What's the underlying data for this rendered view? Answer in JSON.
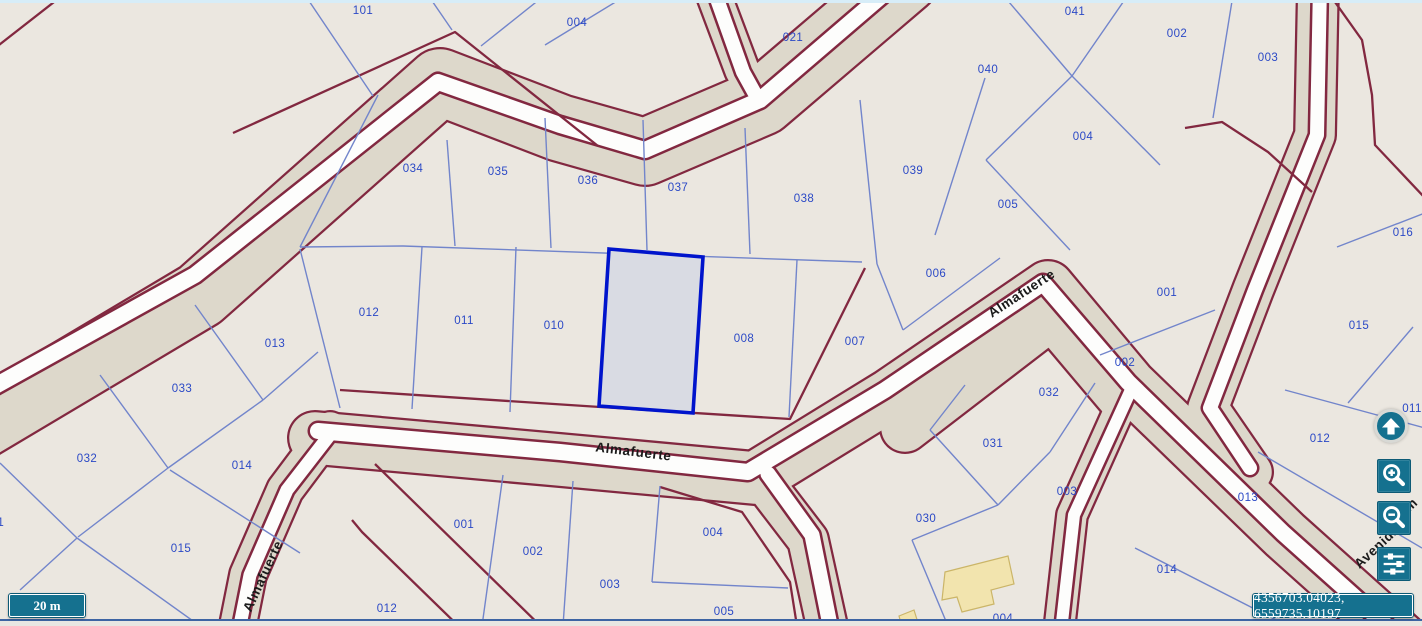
{
  "scale_bar": {
    "label": "20 m"
  },
  "coordinates": {
    "value": "4356703.04023, 6559735.10197"
  },
  "controls": {
    "buttons": [
      {
        "name": "pan-up",
        "icon": "arrow-up-icon"
      },
      {
        "name": "zoom-in",
        "icon": "magnifier-plus-icon"
      },
      {
        "name": "zoom-out",
        "icon": "magnifier-minus-icon"
      },
      {
        "name": "map-settings",
        "icon": "sliders-icon"
      }
    ]
  },
  "map": {
    "colors": {
      "parcel_fill": "#ebe7e0",
      "road_corridor": "#ddd8cb",
      "road_white": "#fdfdfc",
      "block_border": "#822840",
      "parcel_line": "#7285cb",
      "parcel_label": "#2b49c6",
      "street_label": "#1a1a1a",
      "selected_fill": "#d9dbe3",
      "selected_border": "#0014cc",
      "building_fill": "#f2e4ae",
      "building_border": "#cbb568",
      "accent_teal": "#15718f"
    },
    "selected_parcel": {
      "points": [
        [
          609,
          249
        ],
        [
          703,
          257
        ],
        [
          693,
          413
        ],
        [
          599,
          406
        ]
      ]
    },
    "street_labels": [
      {
        "text": "Almafuerte",
        "x": 1024,
        "y": 297,
        "rot": -33
      },
      {
        "text": "Almafuerte",
        "x": 633,
        "y": 456,
        "rot": 7
      },
      {
        "text": "Almafuerte",
        "x": 267,
        "y": 578,
        "rot": -65
      },
      {
        "text": "Avenida",
        "x": 1380,
        "y": 550,
        "rot": -43
      },
      {
        "text": "m",
        "x": 1414,
        "y": 508,
        "rot": -43
      }
    ],
    "parcel_labels": [
      {
        "text": "101",
        "x": 363,
        "y": 10
      },
      {
        "text": "004",
        "x": 577,
        "y": 22
      },
      {
        "text": "021",
        "x": 793,
        "y": 37
      },
      {
        "text": "040",
        "x": 988,
        "y": 69
      },
      {
        "text": "041",
        "x": 1075,
        "y": 11
      },
      {
        "text": "002",
        "x": 1177,
        "y": 33
      },
      {
        "text": "003",
        "x": 1268,
        "y": 57
      },
      {
        "text": "004",
        "x": 1083,
        "y": 136
      },
      {
        "text": "005",
        "x": 1008,
        "y": 204
      },
      {
        "text": "039",
        "x": 913,
        "y": 170
      },
      {
        "text": "038",
        "x": 804,
        "y": 198
      },
      {
        "text": "034",
        "x": 413,
        "y": 168
      },
      {
        "text": "035",
        "x": 498,
        "y": 171
      },
      {
        "text": "036",
        "x": 588,
        "y": 180
      },
      {
        "text": "037",
        "x": 678,
        "y": 187
      },
      {
        "text": "016",
        "x": 1403,
        "y": 232
      },
      {
        "text": "006",
        "x": 936,
        "y": 273
      },
      {
        "text": "001",
        "x": 1167,
        "y": 292
      },
      {
        "text": "015",
        "x": 1359,
        "y": 325
      },
      {
        "text": "012",
        "x": 369,
        "y": 312
      },
      {
        "text": "011",
        "x": 464,
        "y": 320
      },
      {
        "text": "010",
        "x": 554,
        "y": 325
      },
      {
        "text": "008",
        "x": 744,
        "y": 338
      },
      {
        "text": "007",
        "x": 855,
        "y": 341
      },
      {
        "text": "013",
        "x": 275,
        "y": 343
      },
      {
        "text": "033",
        "x": 182,
        "y": 388
      },
      {
        "text": "002",
        "x": 1125,
        "y": 362
      },
      {
        "text": "032",
        "x": 1049,
        "y": 392
      },
      {
        "text": "032",
        "x": 87,
        "y": 458
      },
      {
        "text": "014",
        "x": 242,
        "y": 465
      },
      {
        "text": "031",
        "x": 993,
        "y": 443
      },
      {
        "text": "003",
        "x": 1067,
        "y": 491
      },
      {
        "text": "012",
        "x": 1320,
        "y": 438
      },
      {
        "text": "013",
        "x": 1248,
        "y": 497
      },
      {
        "text": "030",
        "x": 926,
        "y": 518
      },
      {
        "text": "031",
        "x": -6,
        "y": 522
      },
      {
        "text": "015",
        "x": 181,
        "y": 548
      },
      {
        "text": "014",
        "x": 1167,
        "y": 569
      },
      {
        "text": "011",
        "x": 1412,
        "y": 408
      },
      {
        "text": "001",
        "x": 464,
        "y": 524
      },
      {
        "text": "002",
        "x": 533,
        "y": 551
      },
      {
        "text": "003",
        "x": 610,
        "y": 584
      },
      {
        "text": "012",
        "x": 387,
        "y": 608
      },
      {
        "text": "004",
        "x": 713,
        "y": 532
      },
      {
        "text": "005",
        "x": 724,
        "y": 611
      },
      {
        "text": "004",
        "x": 1003,
        "y": 618
      }
    ],
    "roads": [
      {
        "name": "road-upper-left",
        "band": [
          [
            -30,
            432
          ],
          [
            200,
            295
          ],
          [
            440,
            82
          ],
          [
            560,
            128
          ],
          [
            645,
            152
          ],
          [
            762,
            102
          ],
          [
            905,
            -20
          ]
        ],
        "band_width": 70,
        "white": [
          [
            -30,
            400
          ],
          [
            195,
            275
          ],
          [
            438,
            82
          ],
          [
            560,
            125
          ],
          [
            645,
            150
          ],
          [
            760,
            100
          ],
          [
            900,
            -20
          ]
        ],
        "white_width": 16
      },
      {
        "name": "road-top-center",
        "band": [
          [
            710,
            -15
          ],
          [
            742,
            70
          ],
          [
            756,
            94
          ]
        ],
        "band_width": 38,
        "white": [
          [
            712,
            -15
          ],
          [
            743,
            72
          ],
          [
            754,
            92
          ]
        ],
        "white_width": 14
      },
      {
        "name": "street-almafuerte-main",
        "band": [
          [
            315,
            438
          ],
          [
            560,
            460
          ],
          [
            755,
            478
          ],
          [
            890,
            395
          ],
          [
            1048,
            287
          ],
          [
            1130,
            385
          ],
          [
            1285,
            535
          ],
          [
            1400,
            638
          ]
        ],
        "band_width": 56,
        "white": [
          [
            318,
            431
          ],
          [
            560,
            452
          ],
          [
            748,
            472
          ],
          [
            885,
            390
          ],
          [
            1043,
            283
          ],
          [
            1128,
            382
          ],
          [
            1283,
            533
          ],
          [
            1398,
            636
          ]
        ],
        "white_width": 16
      },
      {
        "name": "almafuerte-se-shoulder",
        "band": [
          [
            905,
            428
          ],
          [
            1052,
            315
          ],
          [
            1122,
            398
          ]
        ],
        "band_width": 52,
        "white": null,
        "white_width": 0
      },
      {
        "name": "road-south-branch",
        "band": [
          [
            762,
            480
          ],
          [
            808,
            540
          ],
          [
            830,
            640
          ]
        ],
        "band_width": 44,
        "white": [
          [
            768,
            474
          ],
          [
            812,
            535
          ],
          [
            833,
            640
          ]
        ],
        "white_width": 15
      },
      {
        "name": "road-south-center",
        "band": [
          [
            1128,
            390
          ],
          [
            1072,
            515
          ],
          [
            1058,
            640
          ]
        ],
        "band_width": 34,
        "white": [
          [
            1130,
            392
          ],
          [
            1074,
            515
          ],
          [
            1060,
            640
          ]
        ],
        "white_width": 12
      },
      {
        "name": "street-almafuerte-west",
        "band": [
          [
            330,
            430
          ],
          [
            285,
            490
          ],
          [
            248,
            575
          ],
          [
            235,
            640
          ]
        ],
        "band_width": 40,
        "white": [
          [
            332,
            432
          ],
          [
            287,
            490
          ],
          [
            250,
            575
          ],
          [
            237,
            640
          ]
        ],
        "white_width": 13
      },
      {
        "name": "road-east",
        "band": [
          [
            1318,
            -15
          ],
          [
            1315,
            135
          ],
          [
            1253,
            290
          ],
          [
            1208,
            408
          ],
          [
            1252,
            472
          ]
        ],
        "band_width": 44,
        "white": [
          [
            1320,
            -15
          ],
          [
            1317,
            135
          ],
          [
            1255,
            290
          ],
          [
            1210,
            408
          ],
          [
            1250,
            468
          ]
        ],
        "white_width": 14
      }
    ],
    "block_borders": [
      [
        [
          63,
          -5
        ],
        [
          -10,
          52
        ]
      ],
      [
        [
          233,
          133
        ],
        [
          455,
          32
        ],
        [
          598,
          146
        ]
      ],
      [
        [
          340,
          390
        ],
        [
          600,
          407
        ],
        [
          790,
          419
        ],
        [
          865,
          268
        ]
      ],
      [
        [
          375,
          464
        ],
        [
          560,
          645
        ]
      ],
      [
        [
          352,
          520
        ],
        [
          362,
          532
        ],
        [
          478,
          645
        ]
      ],
      [
        [
          660,
          487
        ],
        [
          742,
          512
        ],
        [
          790,
          582
        ],
        [
          800,
          645
        ]
      ],
      [
        [
          1185,
          128
        ],
        [
          1222,
          122
        ],
        [
          1268,
          152
        ],
        [
          1312,
          192
        ]
      ],
      [
        [
          1330,
          -5
        ],
        [
          1362,
          40
        ],
        [
          1372,
          95
        ],
        [
          1375,
          145
        ],
        [
          1425,
          198
        ]
      ]
    ],
    "parcel_lines": [
      [
        305,
        -5,
        373,
        96
      ],
      [
        428,
        -5,
        452,
        30
      ],
      [
        545,
        -5,
        481,
        46
      ],
      [
        627,
        -5,
        545,
        45
      ],
      [
        378,
        95,
        300,
        247
      ],
      [
        300,
        247,
        403,
        246
      ],
      [
        403,
        246,
        862,
        262
      ],
      [
        447,
        140,
        455,
        246
      ],
      [
        545,
        118,
        551,
        248
      ],
      [
        643,
        120,
        647,
        250
      ],
      [
        745,
        128,
        750,
        254
      ],
      [
        860,
        100,
        877,
        264
      ],
      [
        300,
        249,
        340,
        408
      ],
      [
        422,
        247,
        412,
        409
      ],
      [
        516,
        247,
        510,
        412
      ],
      [
        797,
        260,
        789,
        417
      ],
      [
        1003,
        -5,
        1072,
        76
      ],
      [
        1072,
        76,
        1128,
        -5
      ],
      [
        1233,
        -5,
        1213,
        118
      ],
      [
        1072,
        76,
        1160,
        165
      ],
      [
        1072,
        76,
        986,
        160
      ],
      [
        986,
        160,
        1070,
        250
      ],
      [
        985,
        78,
        935,
        235
      ],
      [
        877,
        264,
        903,
        330
      ],
      [
        903,
        330,
        1000,
        258
      ],
      [
        1100,
        355,
        1215,
        310
      ],
      [
        1337,
        247,
        1425,
        213
      ],
      [
        1285,
        390,
        1425,
        428
      ],
      [
        1413,
        327,
        1348,
        403
      ],
      [
        1258,
        452,
        1422,
        548
      ],
      [
        1135,
        548,
        1288,
        626
      ],
      [
        195,
        305,
        263,
        400
      ],
      [
        100,
        375,
        168,
        468
      ],
      [
        168,
        468,
        78,
        537
      ],
      [
        263,
        400,
        168,
        468
      ],
      [
        263,
        400,
        318,
        352
      ],
      [
        170,
        470,
        300,
        553
      ],
      [
        0,
        463,
        77,
        538
      ],
      [
        77,
        538,
        20,
        590
      ],
      [
        77,
        538,
        200,
        626
      ],
      [
        503,
        475,
        482,
        626
      ],
      [
        573,
        481,
        563,
        626
      ],
      [
        660,
        486,
        652,
        582
      ],
      [
        652,
        582,
        788,
        588
      ],
      [
        965,
        385,
        930,
        430
      ],
      [
        930,
        430,
        998,
        505
      ],
      [
        998,
        505,
        1050,
        452
      ],
      [
        1050,
        452,
        1095,
        383
      ],
      [
        998,
        505,
        912,
        540
      ],
      [
        912,
        540,
        948,
        626
      ]
    ],
    "buildings": [
      {
        "points": [
          [
            945,
            572
          ],
          [
            1008,
            556
          ],
          [
            1014,
            584
          ],
          [
            991,
            590
          ],
          [
            994,
            604
          ],
          [
            962,
            612
          ],
          [
            957,
            597
          ],
          [
            942,
            600
          ]
        ]
      },
      {
        "points": [
          [
            899,
            616
          ],
          [
            914,
            610
          ],
          [
            919,
            626
          ],
          [
            902,
            627
          ]
        ]
      }
    ]
  }
}
